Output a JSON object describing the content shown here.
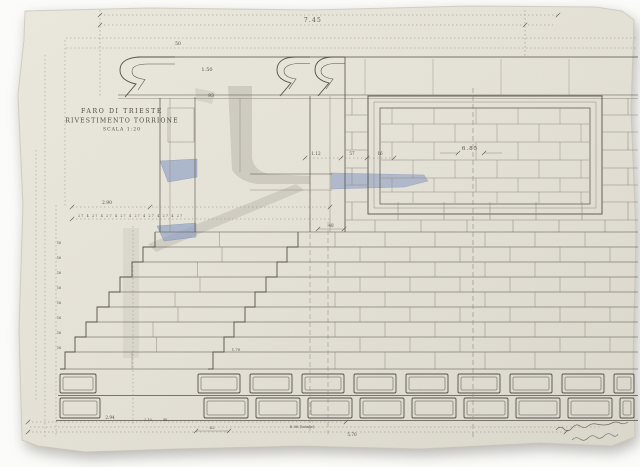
{
  "title_block": {
    "line1": "FARO DI TRIESTE",
    "line2": "RIVESTIMENTO TORRIONE",
    "line3": "SCALA 1:20"
  },
  "dims": {
    "top_width": "7.45",
    "cap": "1.50",
    "cap_small": "50",
    "shaft": "93",
    "panel": "6.85",
    "ledge_a": "1.12",
    "ledge_b": "57",
    "ledge_c": "16",
    "offset": "48",
    "steps_top": "2.90",
    "tread_row": "27 4 27 4 27 4 27 4 27 4 27 4 27 4 27",
    "risers": [
      "16",
      "16",
      "16",
      "16",
      "16",
      "16",
      "16",
      "16"
    ],
    "step_mid": "1.70",
    "base_a": "2.94",
    "base_b": "2.10",
    "base_c": "48",
    "base_d": "62",
    "total_a": "8.96 (totale)",
    "total_b": "5.70"
  },
  "colors": {
    "paper": "#e6e3d8",
    "ink": "#55514a",
    "pencil": "#8f8a7e",
    "blue": "#8fa0c6",
    "grey_wash": "#8d887c",
    "bg": "#fbfbf9"
  }
}
